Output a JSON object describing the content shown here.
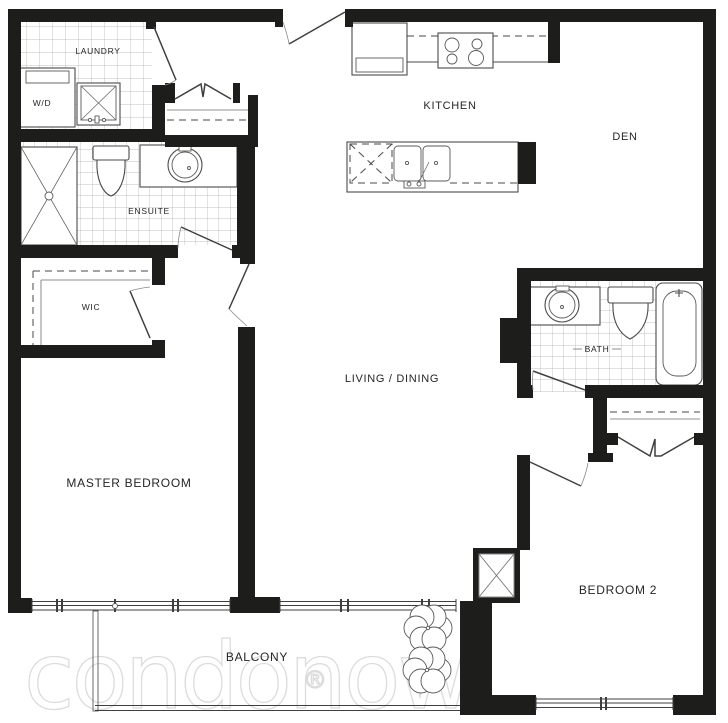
{
  "floorplan": {
    "rooms": {
      "laundry": {
        "label": "LAUNDRY"
      },
      "wd": {
        "label": "W/D"
      },
      "ensuite": {
        "label": "ENSUITE"
      },
      "wic": {
        "label": "WIC"
      },
      "master_bedroom": {
        "label": "MASTER BEDROOM"
      },
      "kitchen": {
        "label": "KITCHEN"
      },
      "den": {
        "label": "DEN"
      },
      "living_dining": {
        "label": "LIVING / DINING"
      },
      "bath": {
        "label": "BATH"
      },
      "bedroom_2": {
        "label": "BEDROOM 2"
      },
      "balcony": {
        "label": "BALCONY"
      }
    },
    "fixtures": [
      "washer-dryer",
      "laundry-sink",
      "shower",
      "ensuite-toilet",
      "ensuite-vanity-sink",
      "closet-shelves",
      "fridge",
      "stove",
      "kitchen-island",
      "dishwasher",
      "double-sink",
      "bath-vanity-sink",
      "bath-toilet",
      "bathtub",
      "service-shaft",
      "balcony-plants",
      "windows",
      "door-swings",
      "bifold-closet-doors"
    ],
    "watermark": {
      "brand": "condonow",
      "registered_mark": "®"
    },
    "colors": {
      "background": "#ffffff",
      "wall": "#1d1d1b",
      "fixture_line": "#4a4a4a",
      "tile_line": "#adadad",
      "label_text": "#262626",
      "watermark": "#dcdcdc"
    }
  }
}
